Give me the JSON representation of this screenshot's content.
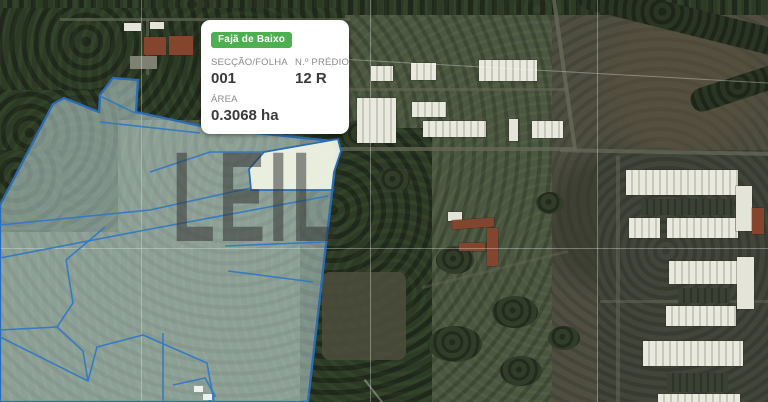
{
  "popup": {
    "badge": "Fajã de Baixo",
    "rows": [
      {
        "label": "SECÇÃO/FOLHA",
        "value": "001"
      },
      {
        "label": "N.º PRÉDIO",
        "value": "12 R"
      },
      {
        "label": "ÁREA",
        "value": "0.3068 ha"
      }
    ]
  },
  "watermark": {
    "text": "LEIL"
  },
  "colors": {
    "badge_green": "#4caf50",
    "parcel_stroke": "#2a6cb5",
    "parcel_fill": "rgba(208,233,233,0.5)",
    "highlight_fill": "rgba(238,242,226,0.95)",
    "grid_white": "rgba(255,255,255,0.32)"
  }
}
